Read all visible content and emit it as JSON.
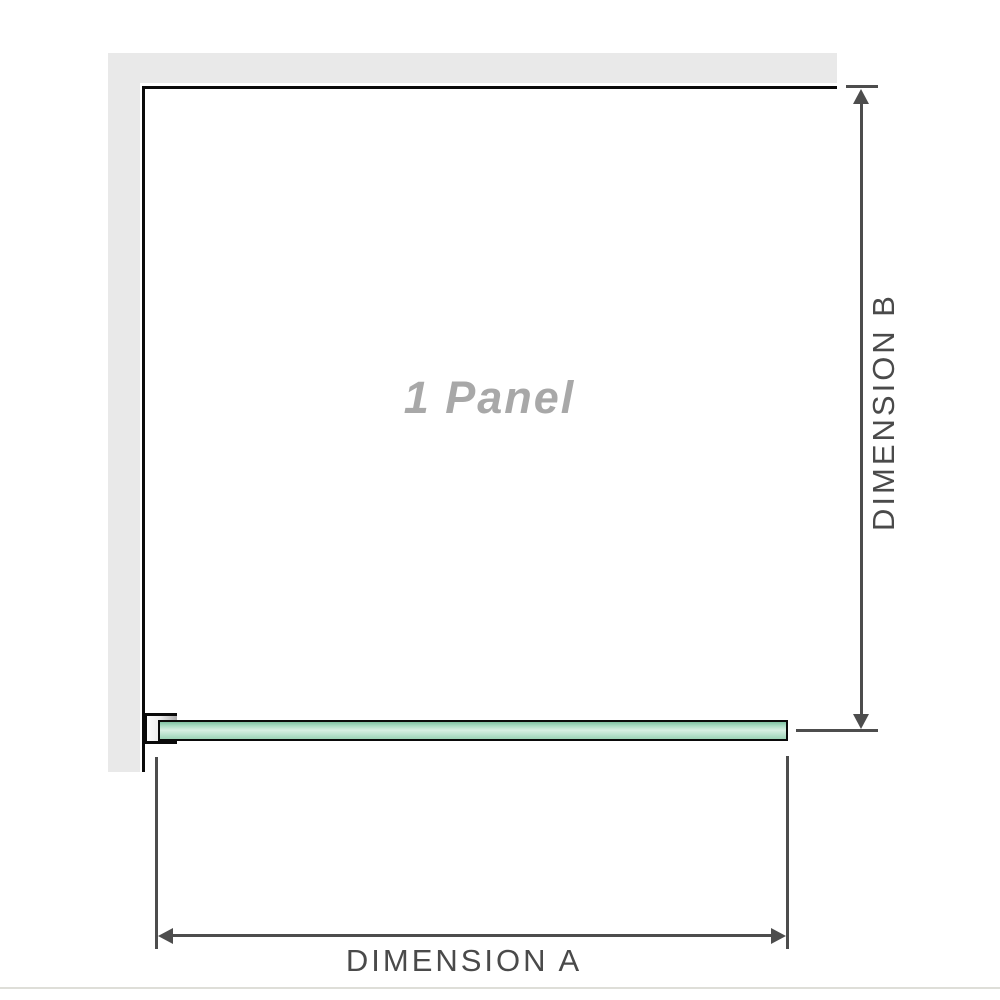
{
  "diagram": {
    "title": "1 panel shower screen dimension diagram",
    "panel_label": "1 Panel",
    "dimension_a_label": "DIMENSION A",
    "dimension_b_label": "DIMENSION B"
  },
  "colors": {
    "wall": "#e9e9e9",
    "panel_outline": "#0a0a0a",
    "dimension_lines": "#4d4d4d",
    "dimension_text": "#4a4a4a",
    "panel_label_text": "#a8a8a8",
    "glass_fill": "#a9dcc3",
    "glass_highlight": "#d7efe3",
    "glass_border": "#0a0a0a",
    "bracket_fill": "#ececec",
    "bottom_rule": "#deded8"
  }
}
